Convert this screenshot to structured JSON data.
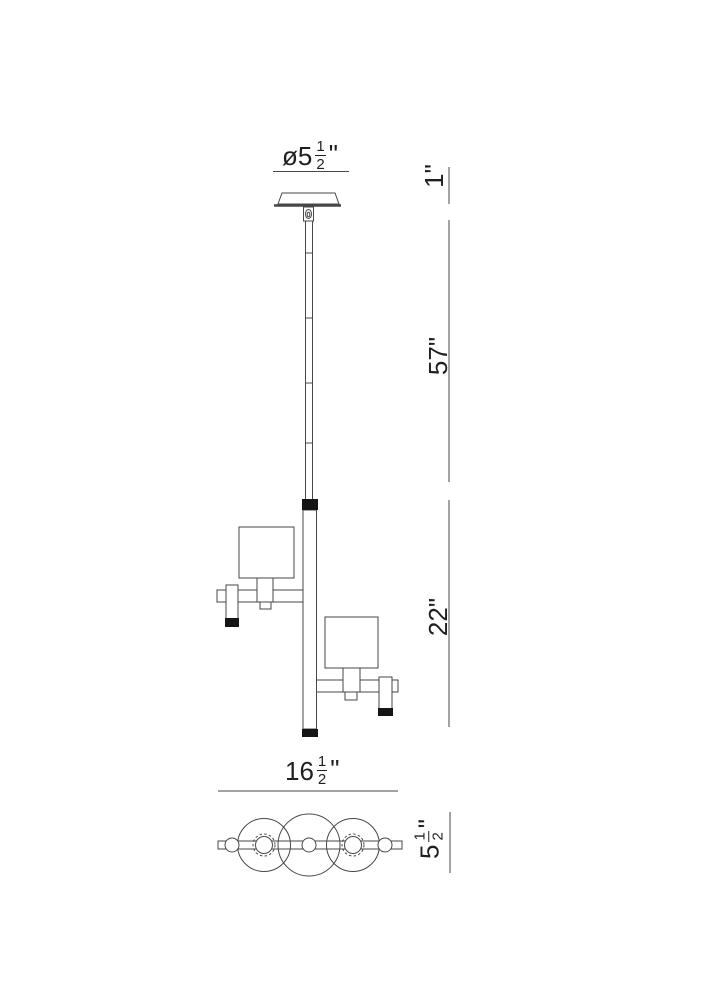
{
  "drawing": {
    "labels": {
      "canopy_diameter": {
        "prefix": "ø5",
        "frac_num": "1",
        "frac_den": "2",
        "suffix": "\""
      },
      "canopy_height": "1\"",
      "rod_drop": "57\"",
      "body_height": "22\"",
      "fixture_width": {
        "prefix": "16",
        "frac_num": "1",
        "frac_den": "2",
        "suffix": "\""
      },
      "fixture_depth": {
        "prefix": "5",
        "frac_num": "1",
        "frac_den": "2",
        "suffix": "\""
      }
    },
    "colors": {
      "line": "#474747",
      "black_fill": "#151515",
      "text": "#1f1f1f",
      "background": "#ffffff"
    }
  }
}
